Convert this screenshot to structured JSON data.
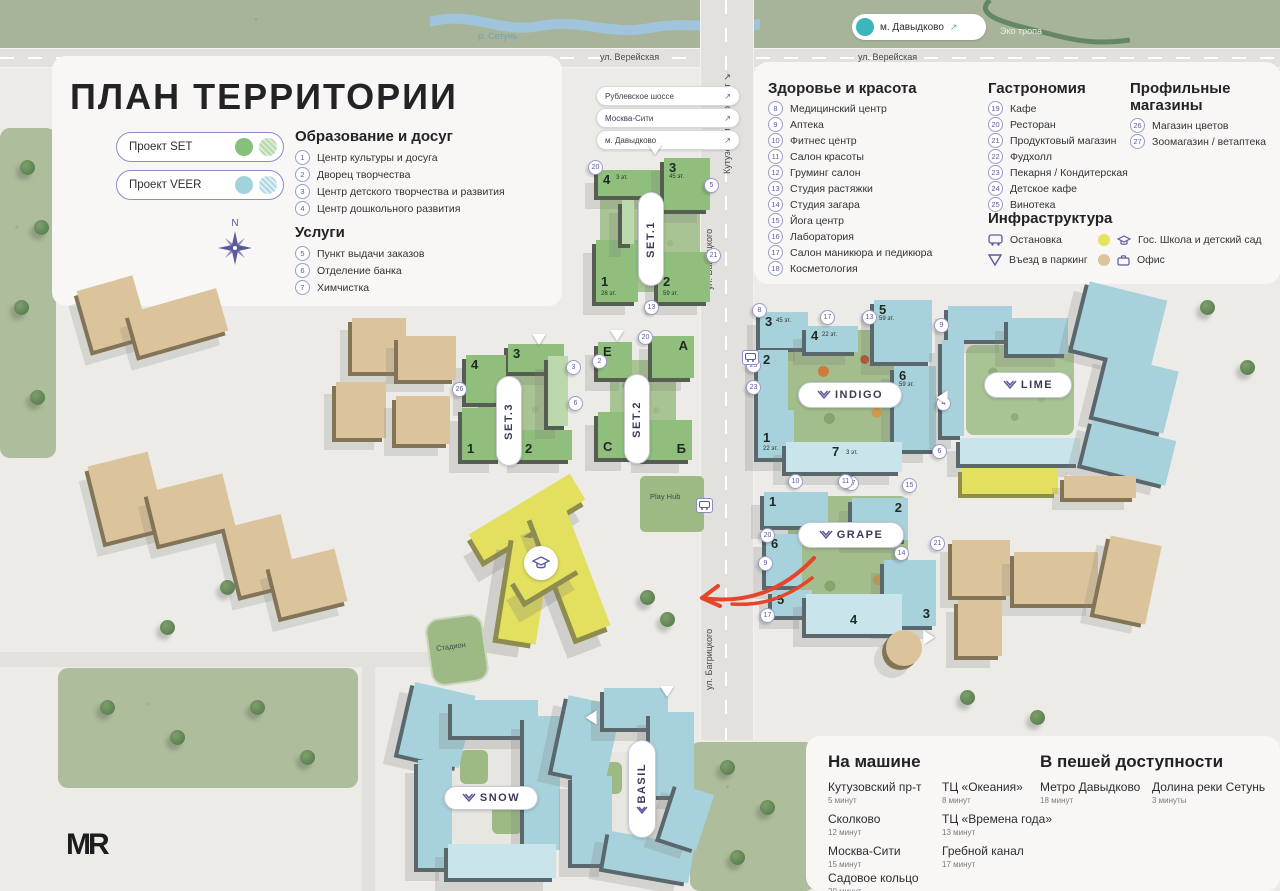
{
  "title": "ПЛАН ТЕРРИТОРИИ",
  "logo": "MR",
  "compass_n": "N",
  "legend": {
    "set": {
      "label": "Проект SET"
    },
    "veer": {
      "label": "Проект VEER"
    }
  },
  "colors": {
    "project_set": "#86c07c",
    "project_veer": "#a2d3dd",
    "accent_purple": "#5d5a9c",
    "metro_teal": "#3bb6bd",
    "school_yellow": "#e5e35e",
    "office_beige": "#dcc49c",
    "arrow_red": "#e4462b"
  },
  "streets": {
    "vereyskaya": "ул. Верейская",
    "bagritskogo": "ул. Багрицкого",
    "kutuzovsky": "Кутузовский проспект ↘",
    "river": "р. Сетунь",
    "eco_trail": "Эко тропа"
  },
  "metro_badge": {
    "label": "м. Давыдково",
    "arrow": "↗"
  },
  "nav_badges": [
    {
      "label": "Рублевское шоссе",
      "arrow": "↗"
    },
    {
      "label": "Москва-Сити",
      "arrow": "↗"
    },
    {
      "label": "м. Давыдково",
      "arrow": "↗"
    }
  ],
  "sections": {
    "education": {
      "header": "Образование и досуг",
      "items": [
        {
          "num": "1",
          "label": "Центр культуры и досуга"
        },
        {
          "num": "2",
          "label": "Дворец творчества"
        },
        {
          "num": "3",
          "label": "Центр детского творчества и развития"
        },
        {
          "num": "4",
          "label": "Центр дошкольного развития"
        }
      ]
    },
    "services": {
      "header": "Услуги",
      "items": [
        {
          "num": "5",
          "label": "Пункт выдачи заказов"
        },
        {
          "num": "6",
          "label": "Отделение банка"
        },
        {
          "num": "7",
          "label": "Химчистка"
        }
      ]
    },
    "health": {
      "header": "Здоровье и красота",
      "items": [
        {
          "num": "8",
          "label": "Медицинский центр"
        },
        {
          "num": "9",
          "label": "Аптека"
        },
        {
          "num": "10",
          "label": "Фитнес центр"
        },
        {
          "num": "11",
          "label": "Салон красоты"
        },
        {
          "num": "12",
          "label": "Груминг салон"
        },
        {
          "num": "13",
          "label": "Студия растяжки"
        },
        {
          "num": "14",
          "label": "Студия загара"
        },
        {
          "num": "15",
          "label": "Йога центр"
        },
        {
          "num": "16",
          "label": "Лаборатория"
        },
        {
          "num": "17",
          "label": "Салон маникюра и педикюра"
        },
        {
          "num": "18",
          "label": "Косметология"
        }
      ]
    },
    "gastronomy": {
      "header": "Гастрономия",
      "items": [
        {
          "num": "19",
          "label": "Кафе"
        },
        {
          "num": "20",
          "label": "Ресторан"
        },
        {
          "num": "21",
          "label": "Продуктовый магазин"
        },
        {
          "num": "22",
          "label": "Фудхолл"
        },
        {
          "num": "23",
          "label": "Пекарня / Кондитерская"
        },
        {
          "num": "24",
          "label": "Детское кафе"
        },
        {
          "num": "25",
          "label": "Винотека"
        }
      ]
    },
    "shops": {
      "header": "Профильные магазины",
      "items": [
        {
          "num": "26",
          "label": "Магазин цветов"
        },
        {
          "num": "27",
          "label": "Зоомагазин / ветаптека"
        }
      ]
    },
    "infrastructure": {
      "header": "Инфраструктура",
      "items": [
        {
          "icon": "bus-stop",
          "label": "Остановка"
        },
        {
          "icon": "parking-entrance",
          "label": "Въезд в паркинг"
        },
        {
          "icon": "school",
          "label": "Гос. Школа и детский сад"
        },
        {
          "icon": "office",
          "label": "Офис"
        }
      ]
    }
  },
  "routes": {
    "car": {
      "header": "На машине",
      "items": [
        {
          "name": "Кутузовский пр-т",
          "time": "5 минут"
        },
        {
          "name": "Сколково",
          "time": "12 минут"
        },
        {
          "name": "Москва-Сити",
          "time": "15 минут"
        },
        {
          "name": "Садовое кольцо",
          "time": "20 минут"
        },
        {
          "name": "ТЦ «Океания»",
          "time": "8 минут"
        },
        {
          "name": "ТЦ «Времена года»",
          "time": "13 минут"
        },
        {
          "name": "Гребной канал",
          "time": "17 минут"
        }
      ]
    },
    "walk": {
      "header": "В пешей доступности",
      "items": [
        {
          "name": "Метро Давыдково",
          "time": "18 минут"
        },
        {
          "name": "Долина реки Сетунь",
          "time": "3 минуты"
        }
      ]
    }
  },
  "blocks": {
    "set1": {
      "name": "SET.1",
      "buildings": [
        {
          "num": "1",
          "floors": "28 эт."
        },
        {
          "num": "2",
          "floors": "59 эт."
        },
        {
          "num": "3",
          "floors": "45 эт."
        },
        {
          "num": "4",
          "floors": "3 эт."
        }
      ],
      "markers": [
        "20",
        "5",
        "21",
        "13"
      ]
    },
    "set2": {
      "name": "SET.2",
      "buildings": [
        {
          "num": "Е"
        },
        {
          "num": "А"
        },
        {
          "num": "С"
        },
        {
          "num": "Б"
        }
      ],
      "markers": [
        "20",
        "2"
      ]
    },
    "set3": {
      "name": "SET.3",
      "buildings": [
        {
          "num": "1"
        },
        {
          "num": "2"
        },
        {
          "num": "3"
        },
        {
          "num": "4"
        }
      ],
      "markers": [
        "3",
        "6",
        "26"
      ]
    },
    "indigo": {
      "name": "INDIGO",
      "buildings": [
        {
          "num": "1",
          "floors": "22 эт."
        },
        {
          "num": "2"
        },
        {
          "num": "3",
          "floors": "45 эт."
        },
        {
          "num": "4",
          "floors": "22 эт."
        },
        {
          "num": "5",
          "floors": "59 эт."
        },
        {
          "num": "6",
          "floors": "59 эт."
        },
        {
          "num": "7",
          "floors": "3 эт."
        }
      ],
      "markers": [
        "8",
        "17",
        "13",
        "9",
        "25",
        "23",
        "4",
        "10",
        "27",
        "6"
      ]
    },
    "lime": {
      "name": "LIME"
    },
    "grape": {
      "name": "GRAPE",
      "buildings": [
        {
          "num": "1"
        },
        {
          "num": "2"
        },
        {
          "num": "3"
        },
        {
          "num": "4"
        },
        {
          "num": "5"
        },
        {
          "num": "6"
        }
      ],
      "markers": [
        "11",
        "15",
        "14",
        "21",
        "20",
        "9",
        "17"
      ]
    },
    "snow": {
      "name": "SNOW"
    },
    "basil": {
      "name": "BASIL"
    }
  },
  "landmarks": {
    "stadium": "Стадион",
    "play_hub": "Play Hub"
  }
}
